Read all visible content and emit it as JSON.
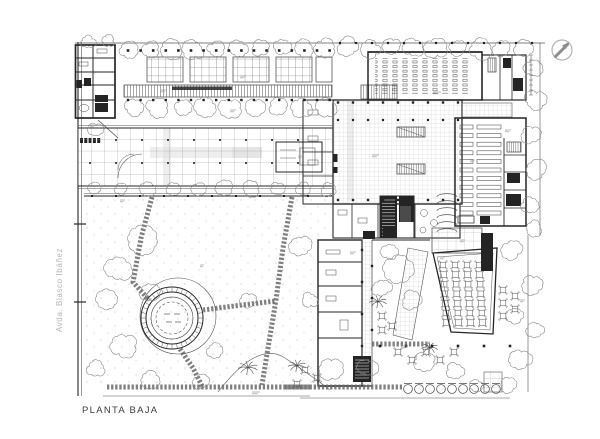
{
  "drawing": {
    "title": "PLANTA BAJA",
    "street_label": "Avda. Blasco Ibáñez"
  },
  "compass": {
    "icon": "north-arrow-icon"
  },
  "colors": {
    "paper": "#ffffff",
    "wall_ink": "#262626",
    "thin_ink": "#555555",
    "grid_ink": "#a9a9a9",
    "fine_grid_ink": "#b8b8b8",
    "tree_ink": "#8a8a8a",
    "dark_fill": "#242424",
    "path_ink": "#6a6a6a",
    "shade": "#d9d9d9",
    "title_text": "#3d3d3d",
    "street_text": "#b5b5b5",
    "compass_ring": "#b3b3b3",
    "compass_needle": "#8c8c8c",
    "annotation": "#9a9a9a"
  }
}
